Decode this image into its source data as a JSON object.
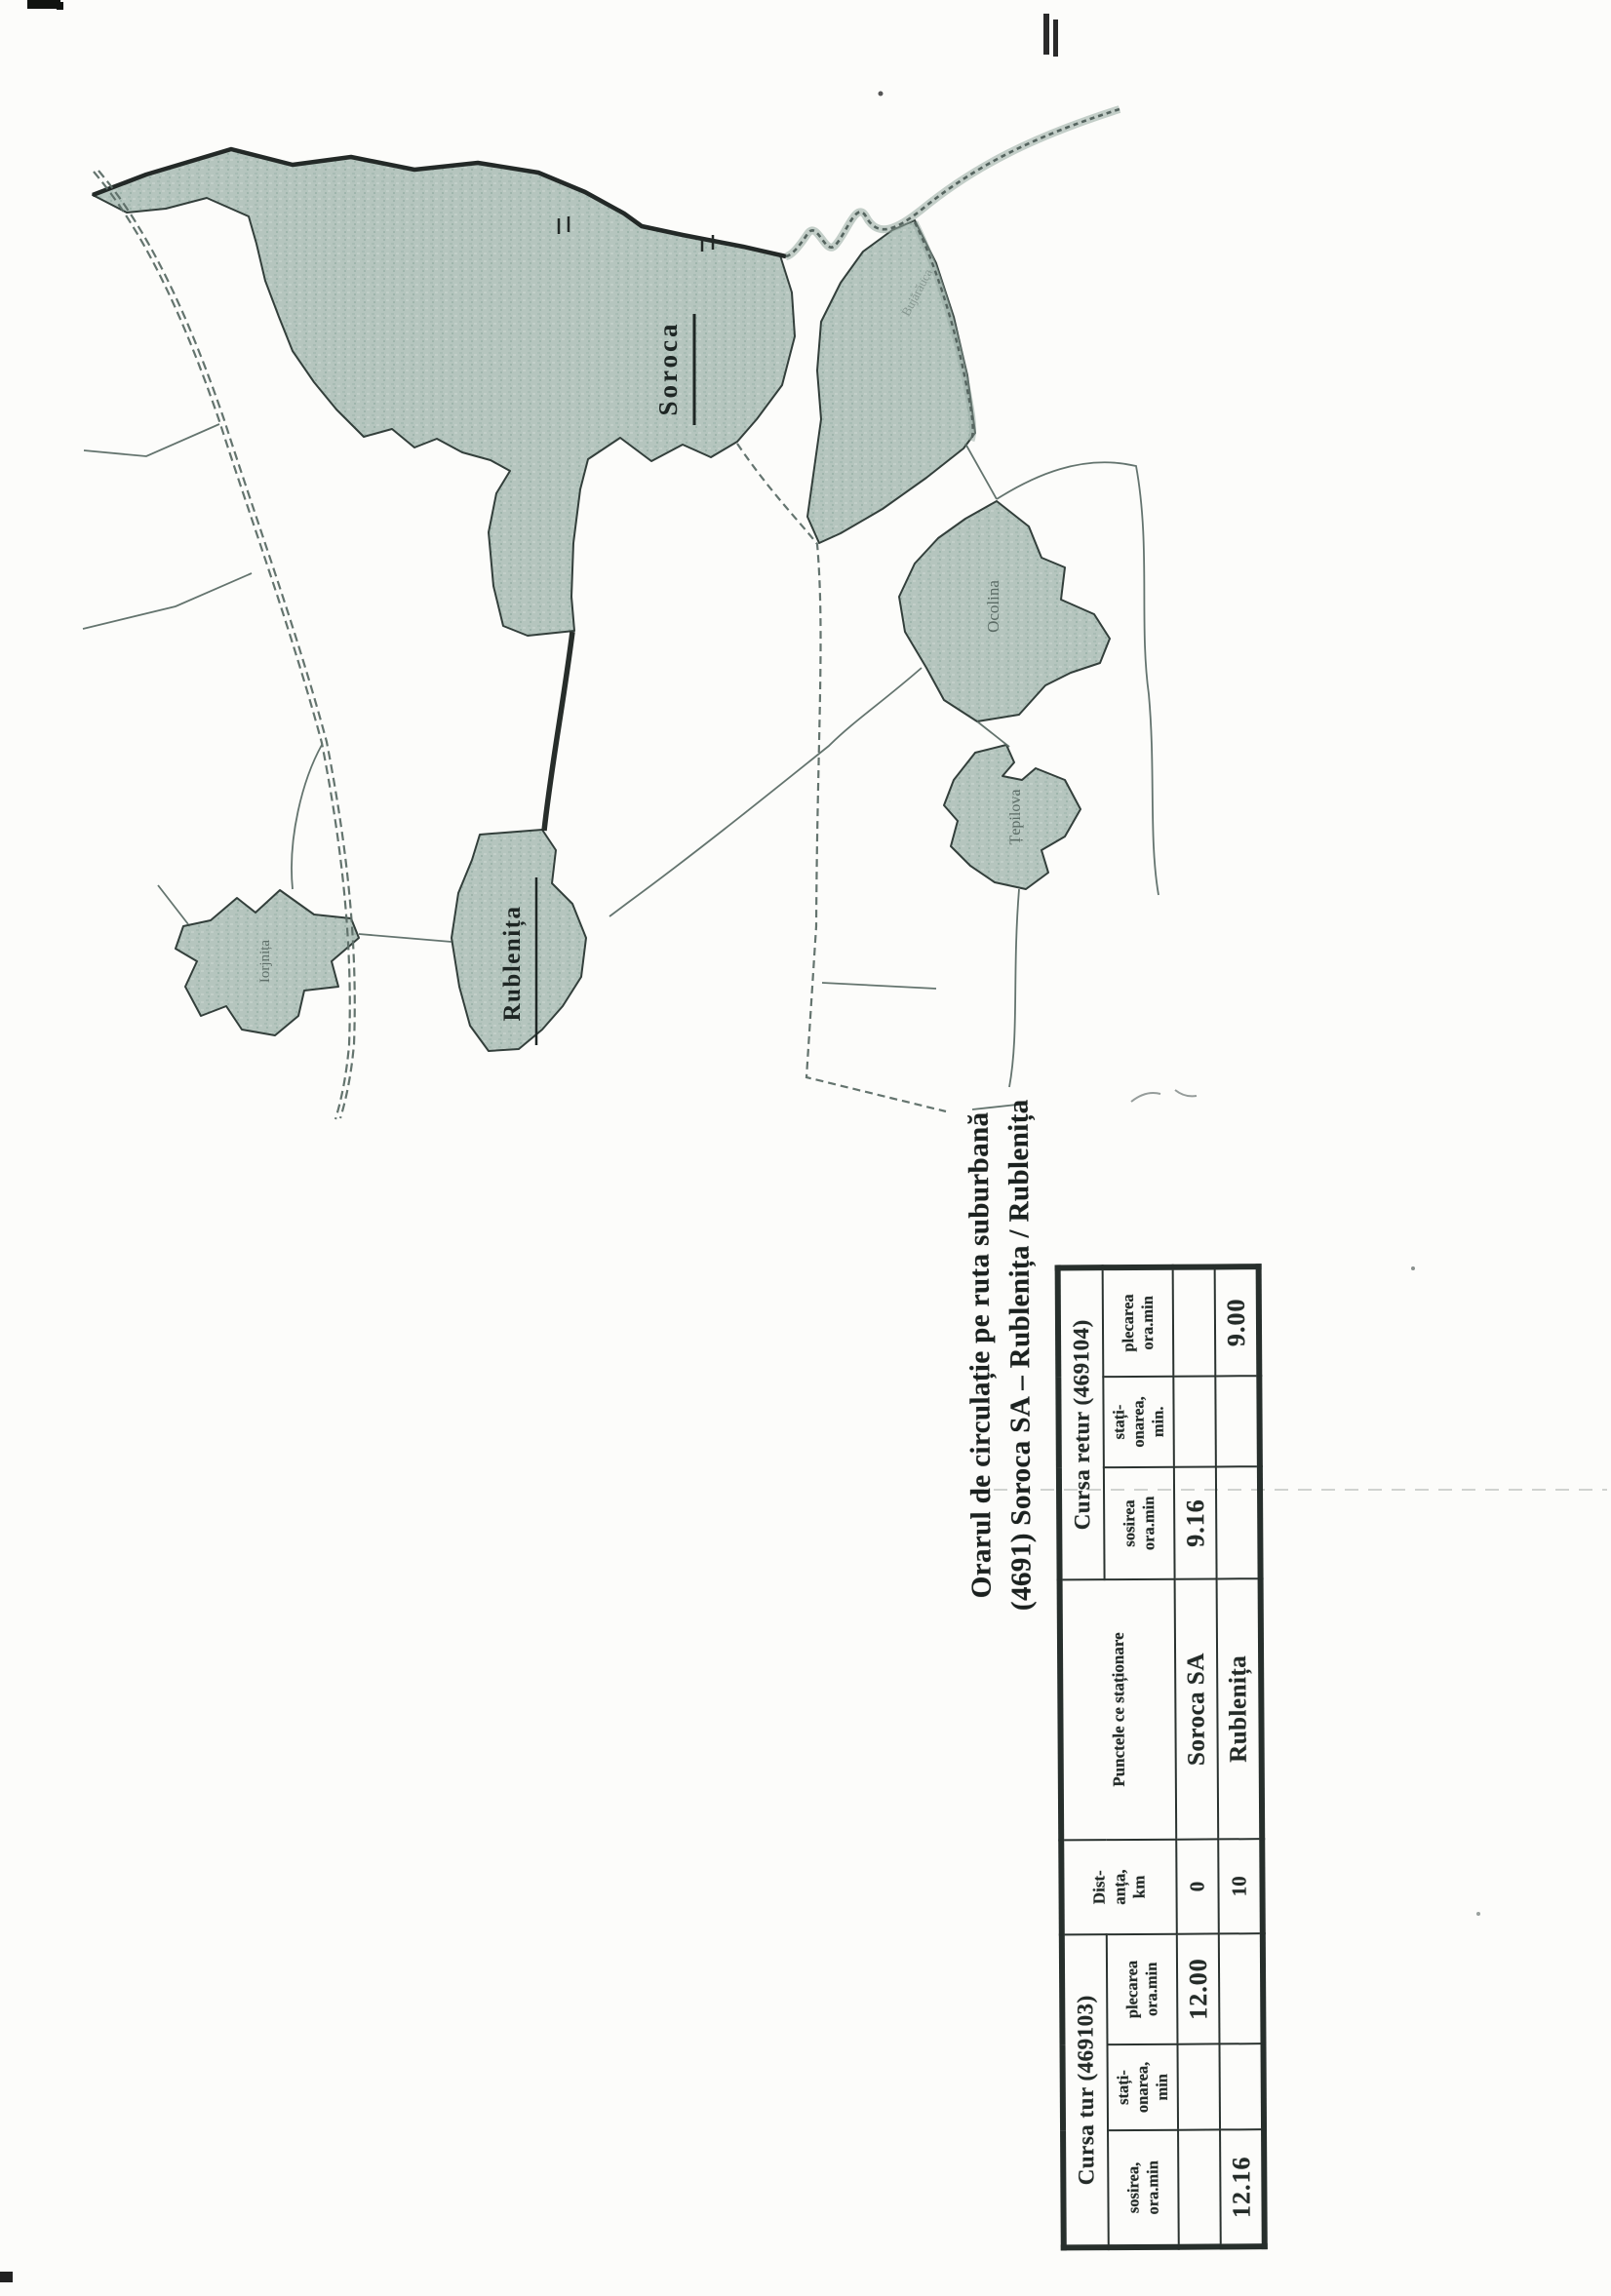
{
  "page": {
    "title_line1": "Orarul de circulație pe ruta suburbană",
    "title_line2": "(4691) Soroca SA – Rublenița / Rublenița"
  },
  "table": {
    "group_tur": "Cursa tur (469103)",
    "group_retur": "Cursa retur (469104)",
    "col_distance": "Dist-\nanța,\nkm",
    "col_points": "Punctele ce staționare",
    "sub_tur_arrival": "sosirea,\nora.min",
    "sub_tur_stop": "stați-\nonarea,\nmin",
    "sub_tur_departure": "plecarea\nora.min",
    "sub_retur_arrival": "sosirea\nora.min",
    "sub_retur_stop": "stați-\nonarea,\nmin.",
    "sub_retur_departure": "plecarea\nora.min",
    "rows": [
      {
        "tur_sosirea": "",
        "tur_stationarea": "",
        "tur_plecarea": "12.00",
        "dist": "0",
        "punct": "Soroca SA",
        "retur_sosirea": "9.16",
        "retur_stationarea": "",
        "retur_plecarea": ""
      },
      {
        "tur_sosirea": "12.16",
        "tur_stationarea": "",
        "tur_plecarea": "",
        "dist": "10",
        "punct": "Rublenița",
        "retur_sosirea": "",
        "retur_stationarea": "",
        "retur_plecarea": "9.00"
      }
    ]
  },
  "map": {
    "labels": {
      "soroca": "Soroca",
      "rublenita": "Rublenița",
      "ocolina": "Ocolina",
      "tepilova": "Țepilova",
      "iorjnita": "Iorjnița",
      "bujarauca": "Bujărăuca"
    }
  },
  "colors": {
    "region_fill": "#b5c5be",
    "region_edge": "#333f3b",
    "ink": "#242b28",
    "road": "#5c6d67",
    "river": "#93a89f"
  }
}
